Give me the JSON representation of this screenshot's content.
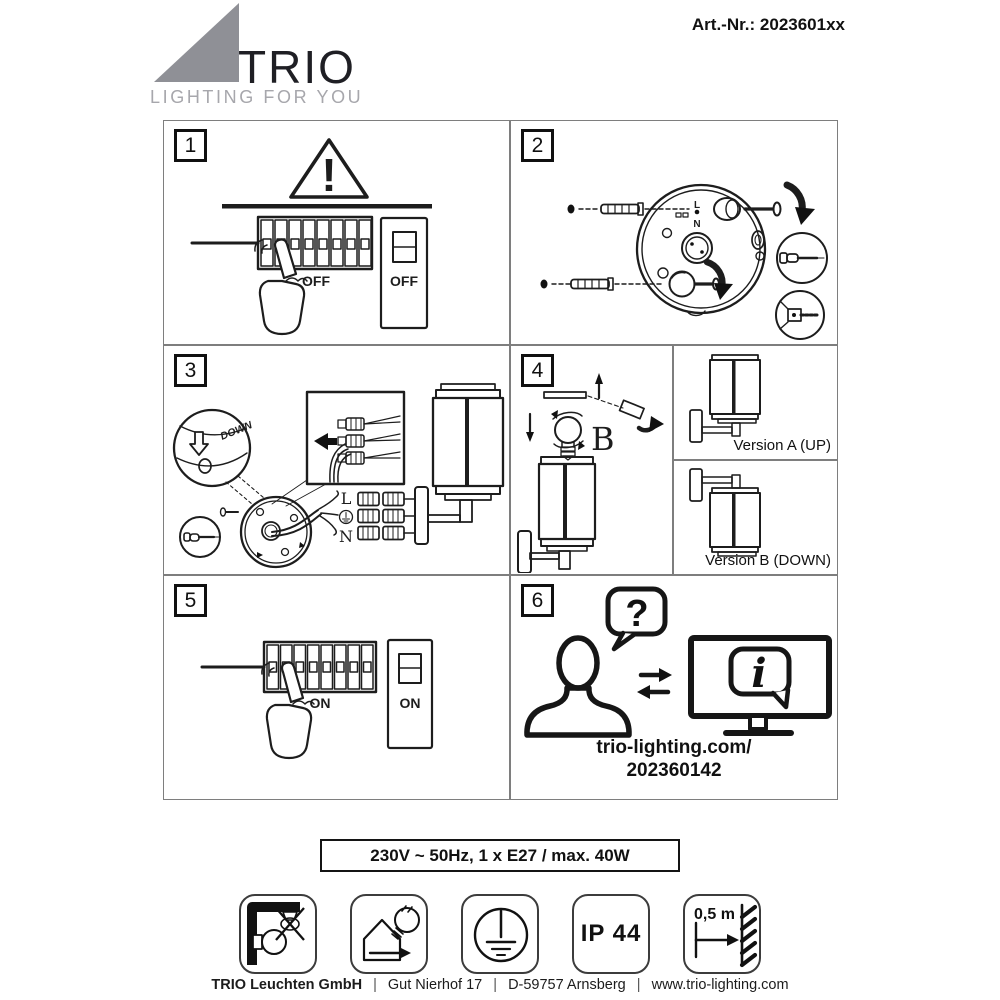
{
  "header": {
    "brand": "TRIO",
    "tagline": "LIGHTING FOR YOU",
    "art_number": "Art.-Nr.: 2023601xx",
    "brand_triangle_color": "#8f9096"
  },
  "panels": {
    "p1": {
      "number": "1",
      "warning": "!",
      "fuse_label": "OFF",
      "switch_label": "OFF"
    },
    "p2": {
      "number": "2",
      "live": "L",
      "neutral": "N"
    },
    "p3": {
      "number": "3",
      "down": "DOWN",
      "live": "L",
      "neutral": "N"
    },
    "p4": {
      "number": "4",
      "bulb": "B",
      "version_a": "Version A (UP)",
      "version_b": "Version B (DOWN)"
    },
    "p5": {
      "number": "5",
      "fuse_label": "ON",
      "switch_label": "ON"
    },
    "p6": {
      "number": "6",
      "question": "?",
      "info": "i",
      "url_line1": "trio-lighting.com/",
      "url_line2": "202360142"
    }
  },
  "specs": {
    "rating": "230V ~ 50Hz, 1 x E27 / max. 40W"
  },
  "symbols": {
    "items": [
      {
        "name": "wall-mount-no-ceiling"
      },
      {
        "name": "house-bulb-replaceable"
      },
      {
        "name": "protection-class-earth"
      },
      {
        "name": "ip-rating",
        "label": "IP 44"
      },
      {
        "name": "min-distance-to-wall",
        "label": "0,5 m"
      }
    ]
  },
  "footer": {
    "company": "TRIO Leuchten GmbH",
    "street": "Gut Nierhof 17",
    "city": "D-59757 Arnsberg",
    "website": "www.trio-lighting.com",
    "separator": "|"
  }
}
